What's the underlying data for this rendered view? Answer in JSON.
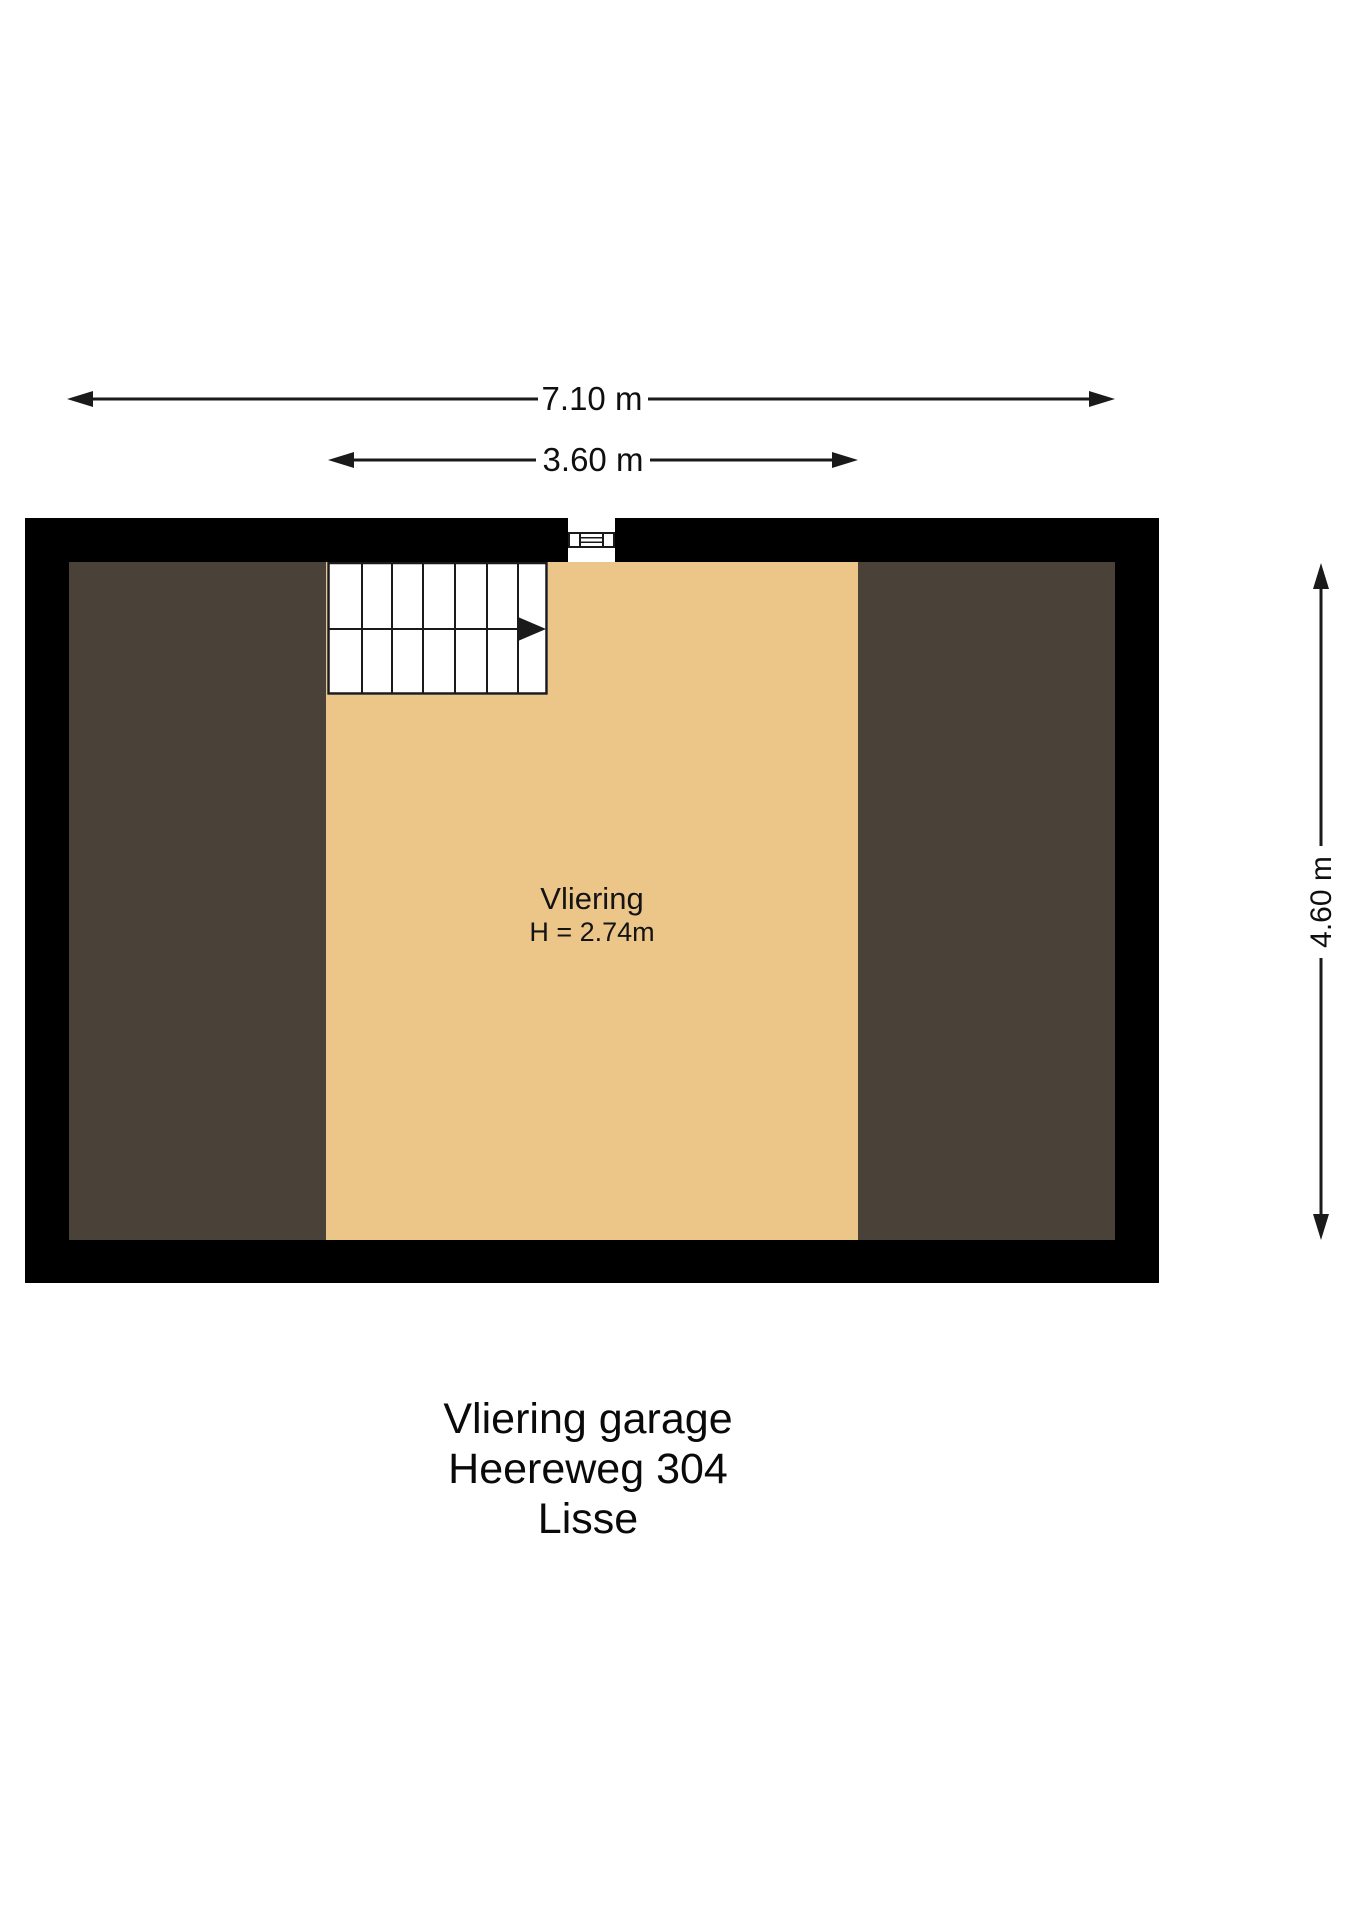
{
  "plan": {
    "room_label": "Vliering",
    "room_height_label": "H = 2.74m"
  },
  "dimensions": {
    "total_width": "7.10 m",
    "attic_width": "3.60 m",
    "total_depth": "4.60 m"
  },
  "caption": {
    "line1": "Vliering garage",
    "line2": "Heereweg 304",
    "line3": "Lisse"
  },
  "colors": {
    "background": "#FFFFFF",
    "wall": "#000000",
    "floor_center": "#ECC589",
    "floor_sides": "#4A4238",
    "line": "#1A1A1A"
  }
}
